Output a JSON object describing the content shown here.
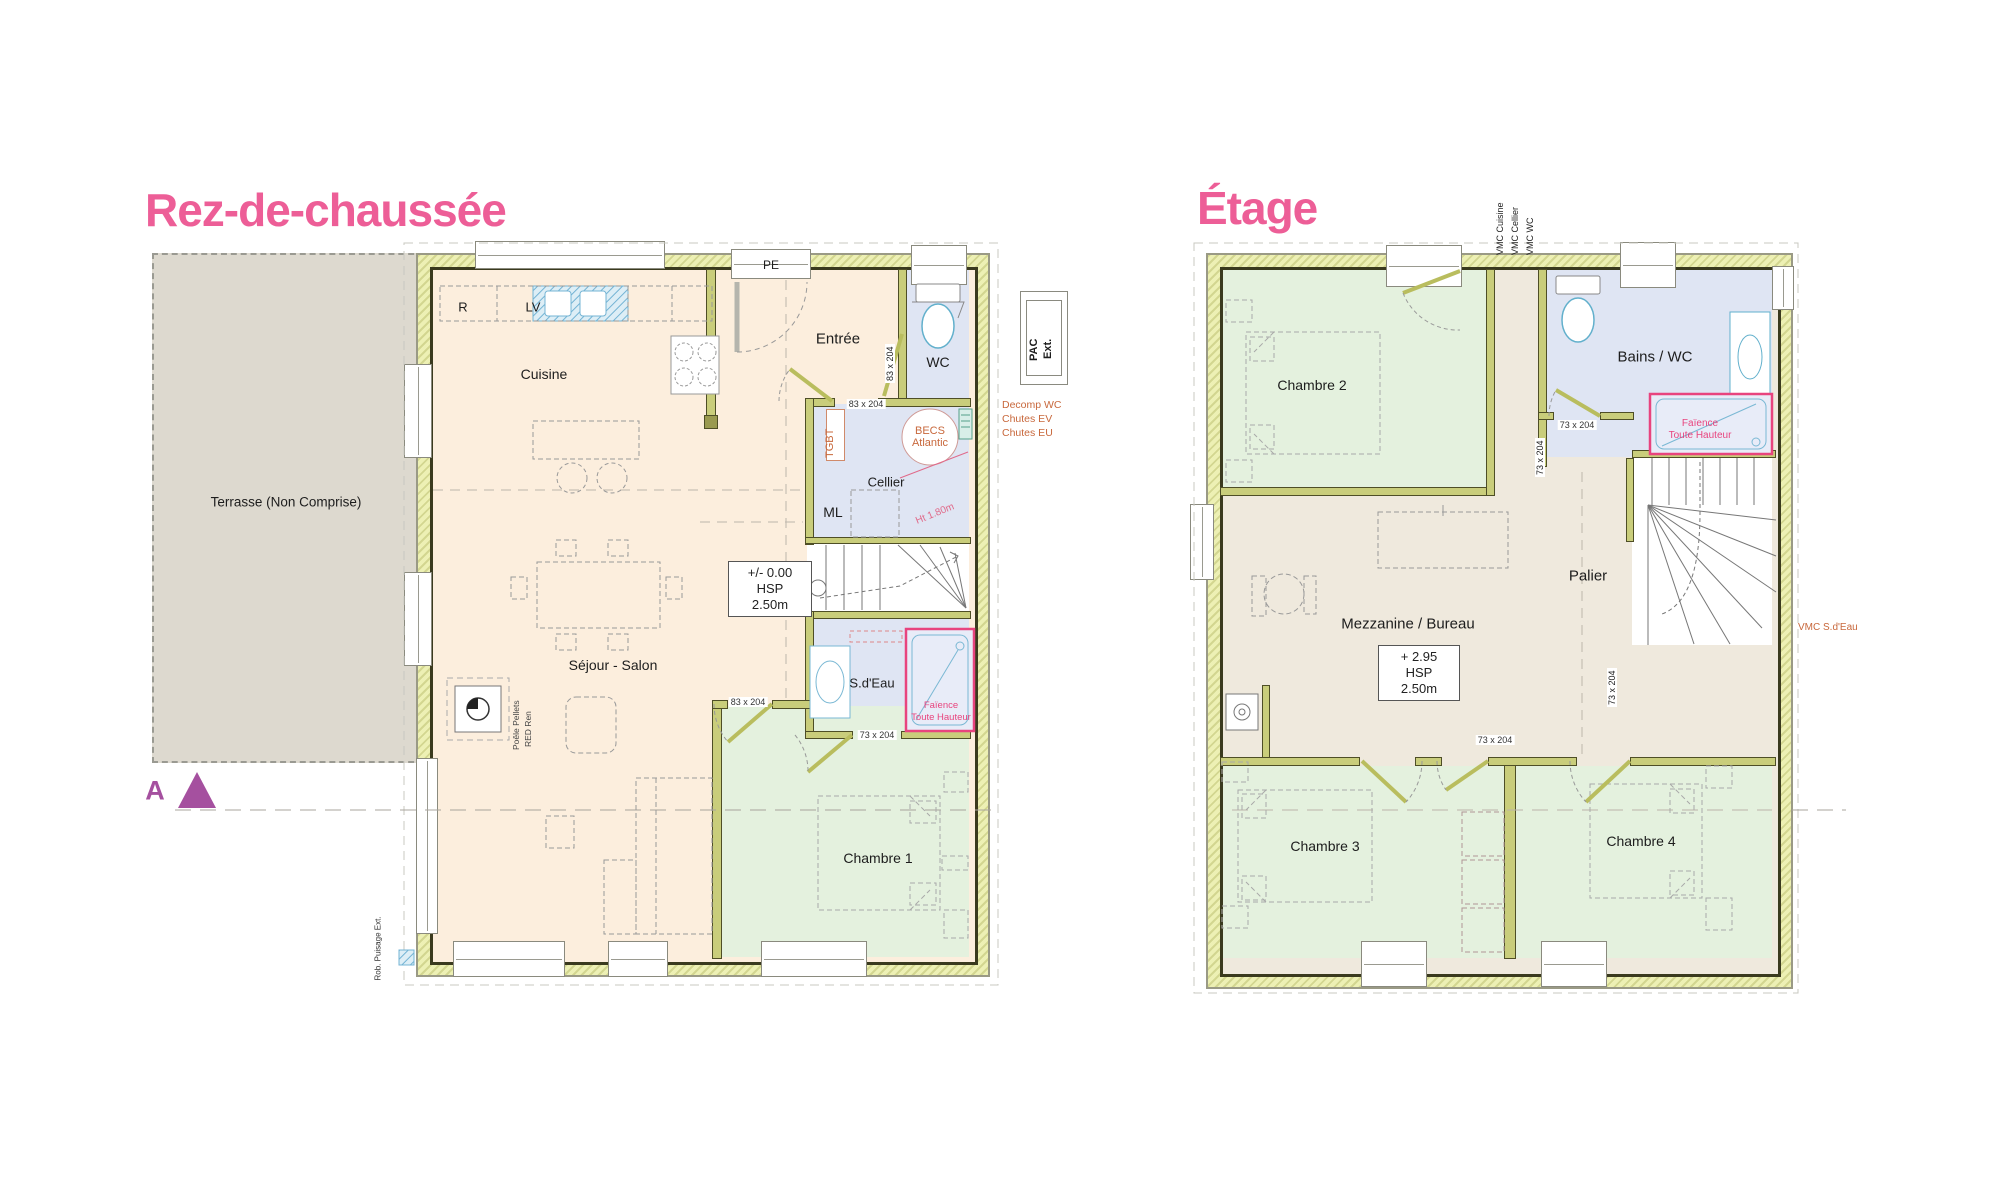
{
  "titles": {
    "rdc": "Rez-de-chaussée",
    "etage": "Étage"
  },
  "colors": {
    "accent_pink": "#ed5e97",
    "annotation_orange": "#c8683c",
    "faience_pink": "#e8447e",
    "section_purple": "#a5509f",
    "wall_olive": "#edf0b4",
    "room_peach": "#fceedd",
    "room_blue": "#dfe5f3",
    "room_green": "#e4f1de",
    "room_beige": "#efe9dd",
    "terrace_gray": "#ddd9cf"
  },
  "rdc": {
    "terrasse": "Terrasse (Non Comprise)",
    "rooms": {
      "cuisine": "Cuisine",
      "entree": "Entrée",
      "wc": "WC",
      "cellier": "Cellier",
      "sejour": "Séjour - Salon",
      "sdeau": "S.d'Eau",
      "chambre1": "Chambre 1"
    },
    "equip": {
      "r": "R",
      "lv": "LV",
      "pe": "PE",
      "ml": "ML",
      "tgbt": "TGBT",
      "becs1": "BECS",
      "becs2": "Atlantic",
      "poele1": "Poêle Pellets",
      "poele2": "RED Ren"
    },
    "notes": {
      "level": "+/- 0.00",
      "hsp": "HSP 2.50m",
      "ht180": "Ht 1.80m",
      "faience1": "Faïence",
      "faience2": "Toute Hauteur",
      "rob": "Rob. Puisage Ext.",
      "section": "A"
    },
    "doors": {
      "d83": "83 x 204",
      "d73": "73 x 204"
    },
    "ext": {
      "pac1": "PAC",
      "pac2": "Ext.",
      "decomp": "Decomp WC",
      "chutes_ev": "Chutes EV",
      "chutes_eu": "Chutes EU"
    }
  },
  "etage": {
    "rooms": {
      "chambre2": "Chambre 2",
      "bains": "Bains / WC",
      "palier": "Palier",
      "mezz": "Mezzanine / Bureau",
      "chambre3": "Chambre 3",
      "chambre4": "Chambre 4"
    },
    "notes": {
      "level": "+ 2.95",
      "hsp": "HSP 2.50m",
      "faience1": "Faïence",
      "faience2": "Toute Hauteur"
    },
    "doors": {
      "d73": "73 x 204"
    },
    "ext": {
      "vmc_cuisine": "VMC Cuisine",
      "vmc_cellier": "VMC Cellier",
      "vmc_wc": "VMC WC",
      "vmc_sdeau": "VMC S.d'Eau"
    }
  }
}
